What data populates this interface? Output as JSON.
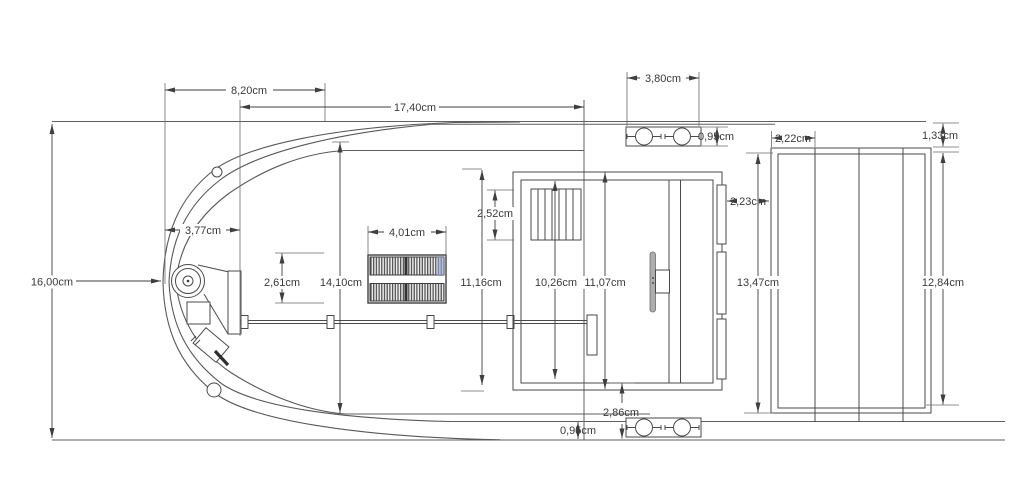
{
  "dimensions": {
    "beam": "16,00cm",
    "bow_offset": "8,20cm",
    "overall_length": "17,40cm",
    "nose_width": "3,77cm",
    "deck_length": "14,10cm",
    "hatch_height": "2,61cm",
    "hatch_width": "4,01cm",
    "vent_height": "2,52cm",
    "cockpit_length": "11,16cm",
    "cabin_inner_length": "10,26cm",
    "cabin_outer_length": "11,07cm",
    "cleat_width": "3,80cm",
    "cleat_height": "0,95cm",
    "cabin_panel_gap": "2,23cm",
    "panel_inset": "2,22cm",
    "panel_top_gap": "1,33cm",
    "panel_outer_height": "13,47cm",
    "panel_inner_height": "12,84cm",
    "stern_clearance": "2,86cm",
    "hull_bottom_gap": "0,95cm"
  }
}
